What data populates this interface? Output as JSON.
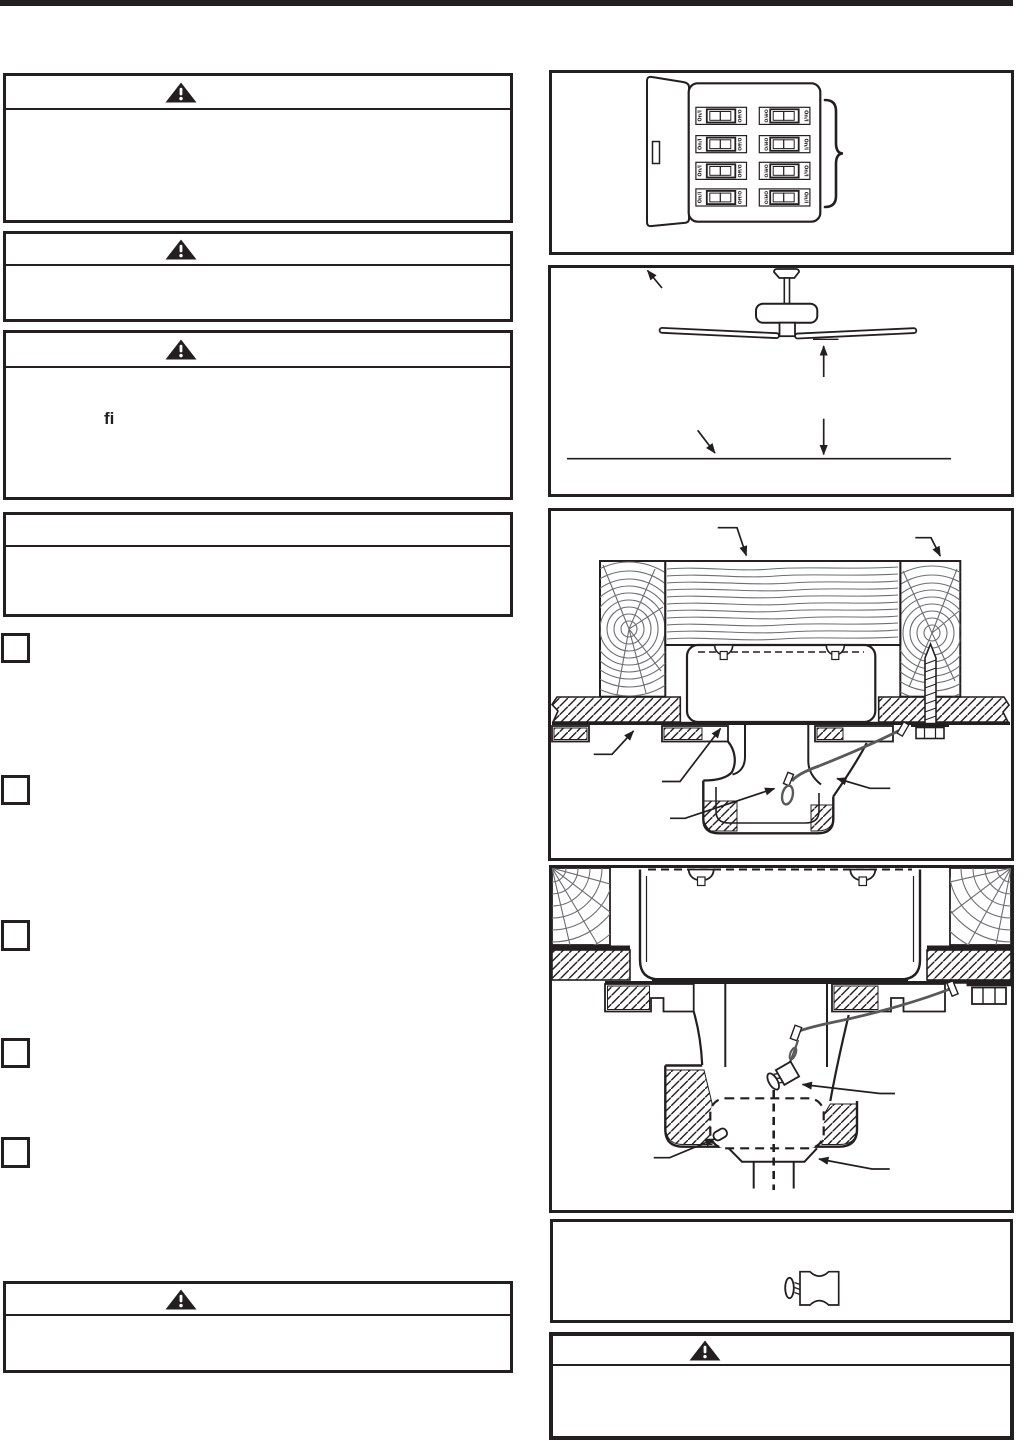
{
  "page": {
    "background": "#ffffff",
    "ink": "#231f20",
    "wood_grain_color": "#6d6e71",
    "cable_color": "#58595b",
    "top_bar_color": "#231f20"
  },
  "left_column": {
    "warning_box_1": {
      "icon": "warning-triangle-icon",
      "header_text": "",
      "body_text": ""
    },
    "warning_box_2": {
      "icon": "warning-triangle-icon",
      "header_text": "",
      "body_text": ""
    },
    "warning_box_3": {
      "icon": "warning-triangle-icon",
      "header_text": "",
      "body_text_fragment": "fi"
    },
    "notice_box": {
      "header_text": "",
      "body_text": ""
    },
    "step_checkboxes": {
      "count": 5
    },
    "warning_box_bottom": {
      "icon": "warning-triangle-icon",
      "header_text": "",
      "body_text": ""
    }
  },
  "right_column": {
    "figure_breaker_panel": {
      "figure": "circuit-breaker-panel",
      "breakers": 8,
      "on_label": "On/I",
      "off_label": "Off/O"
    },
    "figure_fan_clearance": {
      "figure": "ceiling-fan-floor-clearance"
    },
    "figure_bracket_joist": {
      "figure": "mounting-bracket-joist-cross-section"
    },
    "figure_hanger_ball": {
      "figure": "hanger-ball-in-bracket-cross-section"
    },
    "figure_cable_clamp": {
      "figure": "cable-clamp-part"
    },
    "warning_box": {
      "icon": "warning-triangle-icon",
      "header_text": "",
      "body_text": ""
    }
  }
}
